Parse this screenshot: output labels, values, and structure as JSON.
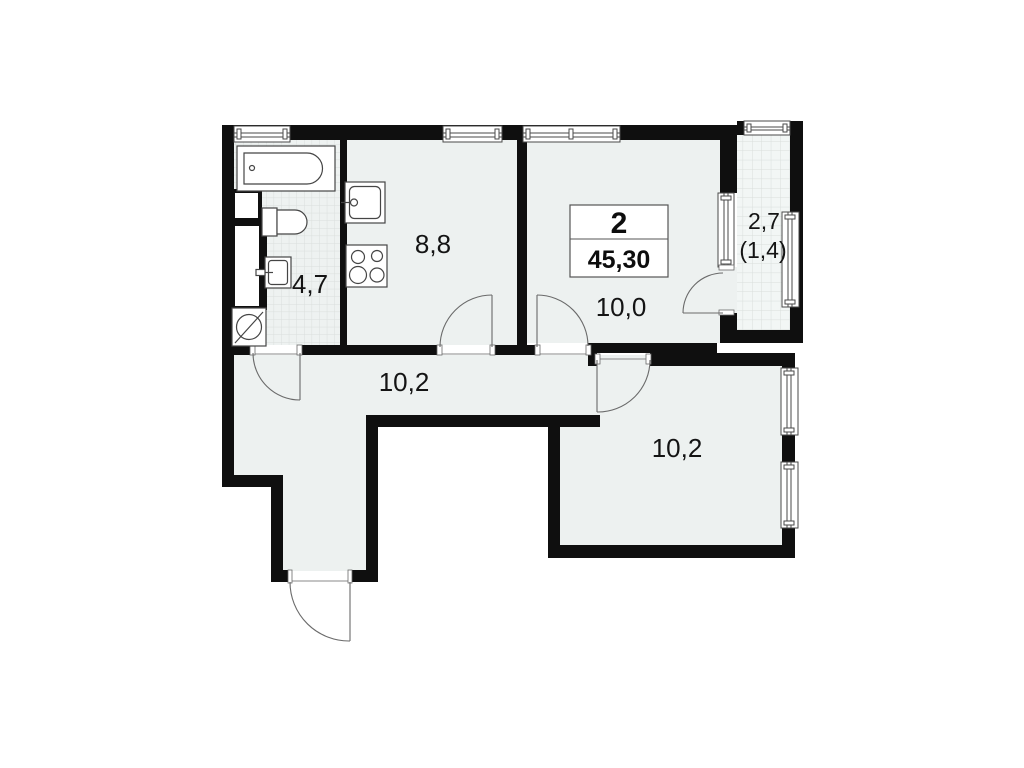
{
  "plan": {
    "stat_box": {
      "rooms_count": "2",
      "total_area": "45,30"
    },
    "labels": {
      "bathroom": "4,7",
      "kitchen": "8,8",
      "living_room": "10,0",
      "hallway": "10,2",
      "bedroom": "10,2",
      "balcony_area": "2,7",
      "balcony_reduced": "(1,4)"
    },
    "fixtures": {
      "bathtub": "bathtub",
      "toilet": "toilet",
      "washbasin": "washbasin",
      "washing_machine": "washing-machine",
      "kitchen_sink": "kitchen-sink",
      "stove": "stove"
    },
    "colors": {
      "wall": "#0f0f0f",
      "room_fill": "#edf1f0",
      "tile_line": "#d9dedc",
      "background": "#ffffff"
    }
  }
}
